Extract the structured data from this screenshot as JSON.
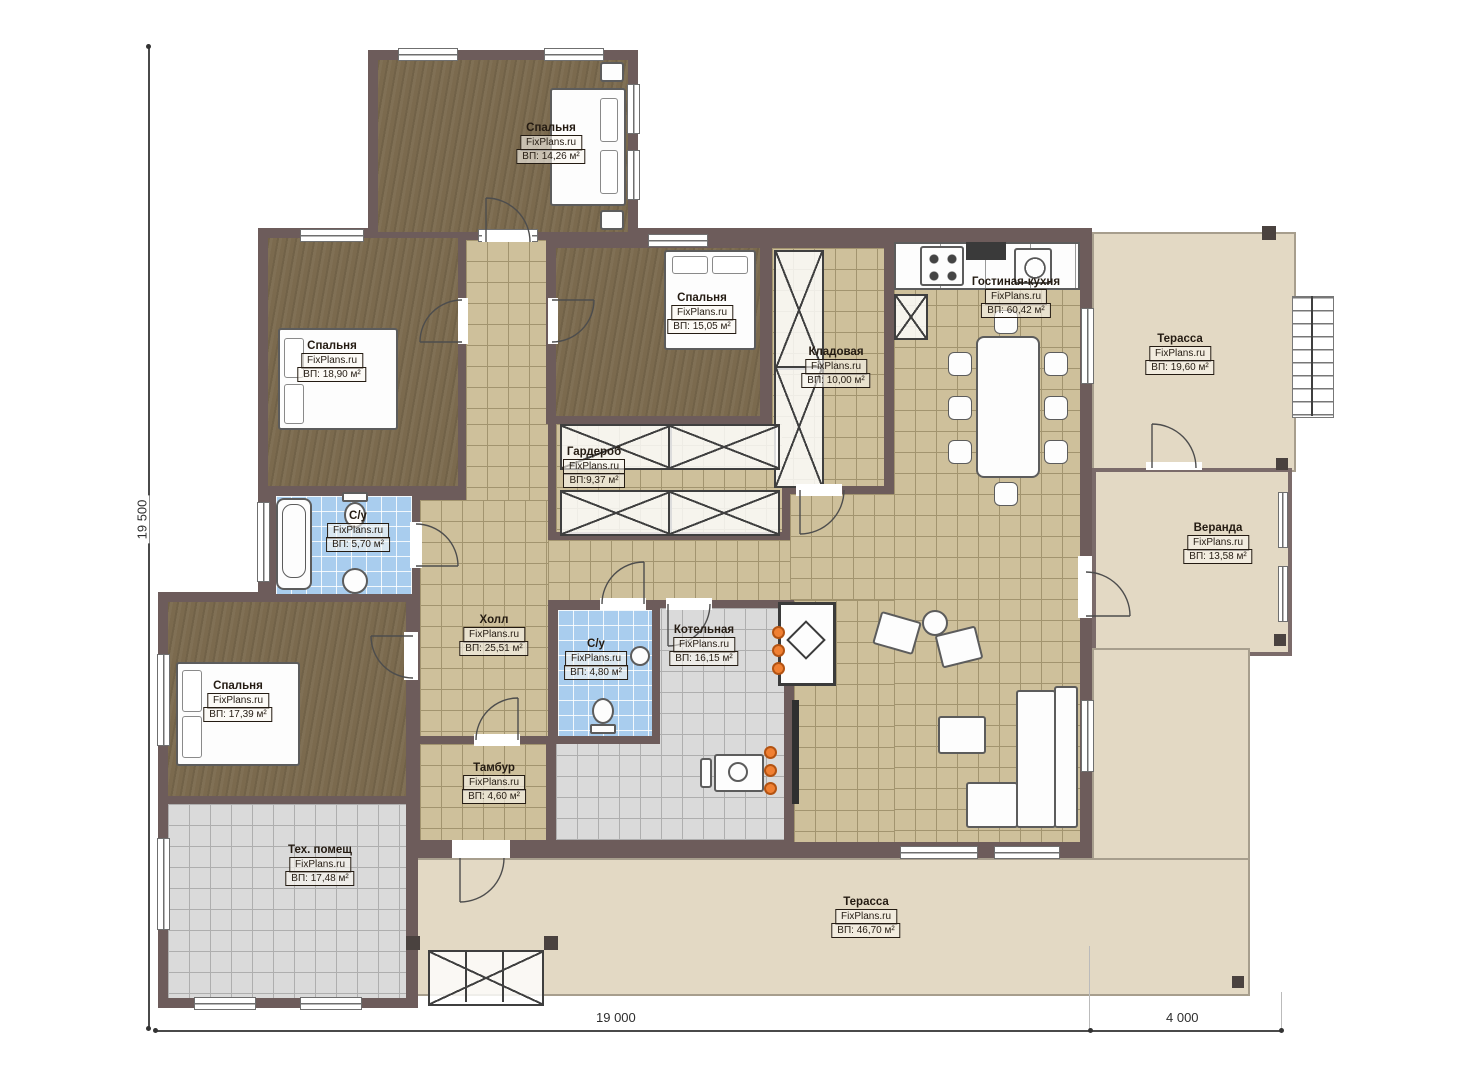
{
  "plan": {
    "brand": "FixPlans.ru",
    "rooms": [
      {
        "name": "Спальня",
        "area": "ВП: 14,26 м²"
      },
      {
        "name": "Спальня",
        "area": "ВП: 18,90 м²"
      },
      {
        "name": "Спальня",
        "area": "ВП: 15,05 м²"
      },
      {
        "name": "Кладовая",
        "area": "ВП: 10,00 м²"
      },
      {
        "name": "Гостиная-кухня",
        "area": "ВП: 60,42 м²"
      },
      {
        "name": "Терасса",
        "area": "ВП: 19,60 м²"
      },
      {
        "name": "Веранда",
        "area": "ВП: 13,58 м²"
      },
      {
        "name": "Гардероб",
        "area": "ВП:9,37 м²"
      },
      {
        "name": "С/у",
        "area": "ВП: 5,70 м²"
      },
      {
        "name": "Холл",
        "area": "ВП: 25,51 м²"
      },
      {
        "name": "С/у",
        "area": "ВП: 4,80 м²"
      },
      {
        "name": "Котельная",
        "area": "ВП: 16,15 м²"
      },
      {
        "name": "Спальня",
        "area": "ВП: 17,39 м²"
      },
      {
        "name": "Тамбур",
        "area": "ВП: 4,60 м²"
      },
      {
        "name": "Тех. помещ",
        "area": "ВП: 17,48 м²"
      },
      {
        "name": "Терасса",
        "area": "ВП: 46,70 м²"
      }
    ],
    "dimensions": {
      "left": "19 500",
      "bottom_main": "19 000",
      "bottom_right": "4 000"
    },
    "colors": {
      "wall": "#6d5c5b",
      "floor_wood": "#7b6a4e",
      "tile_beige": "#cec09b",
      "tile_blue": "#a9cdee",
      "tile_gray": "#dadada",
      "terrace": "#e3d9c4",
      "heating_dot": "#f08033"
    }
  }
}
